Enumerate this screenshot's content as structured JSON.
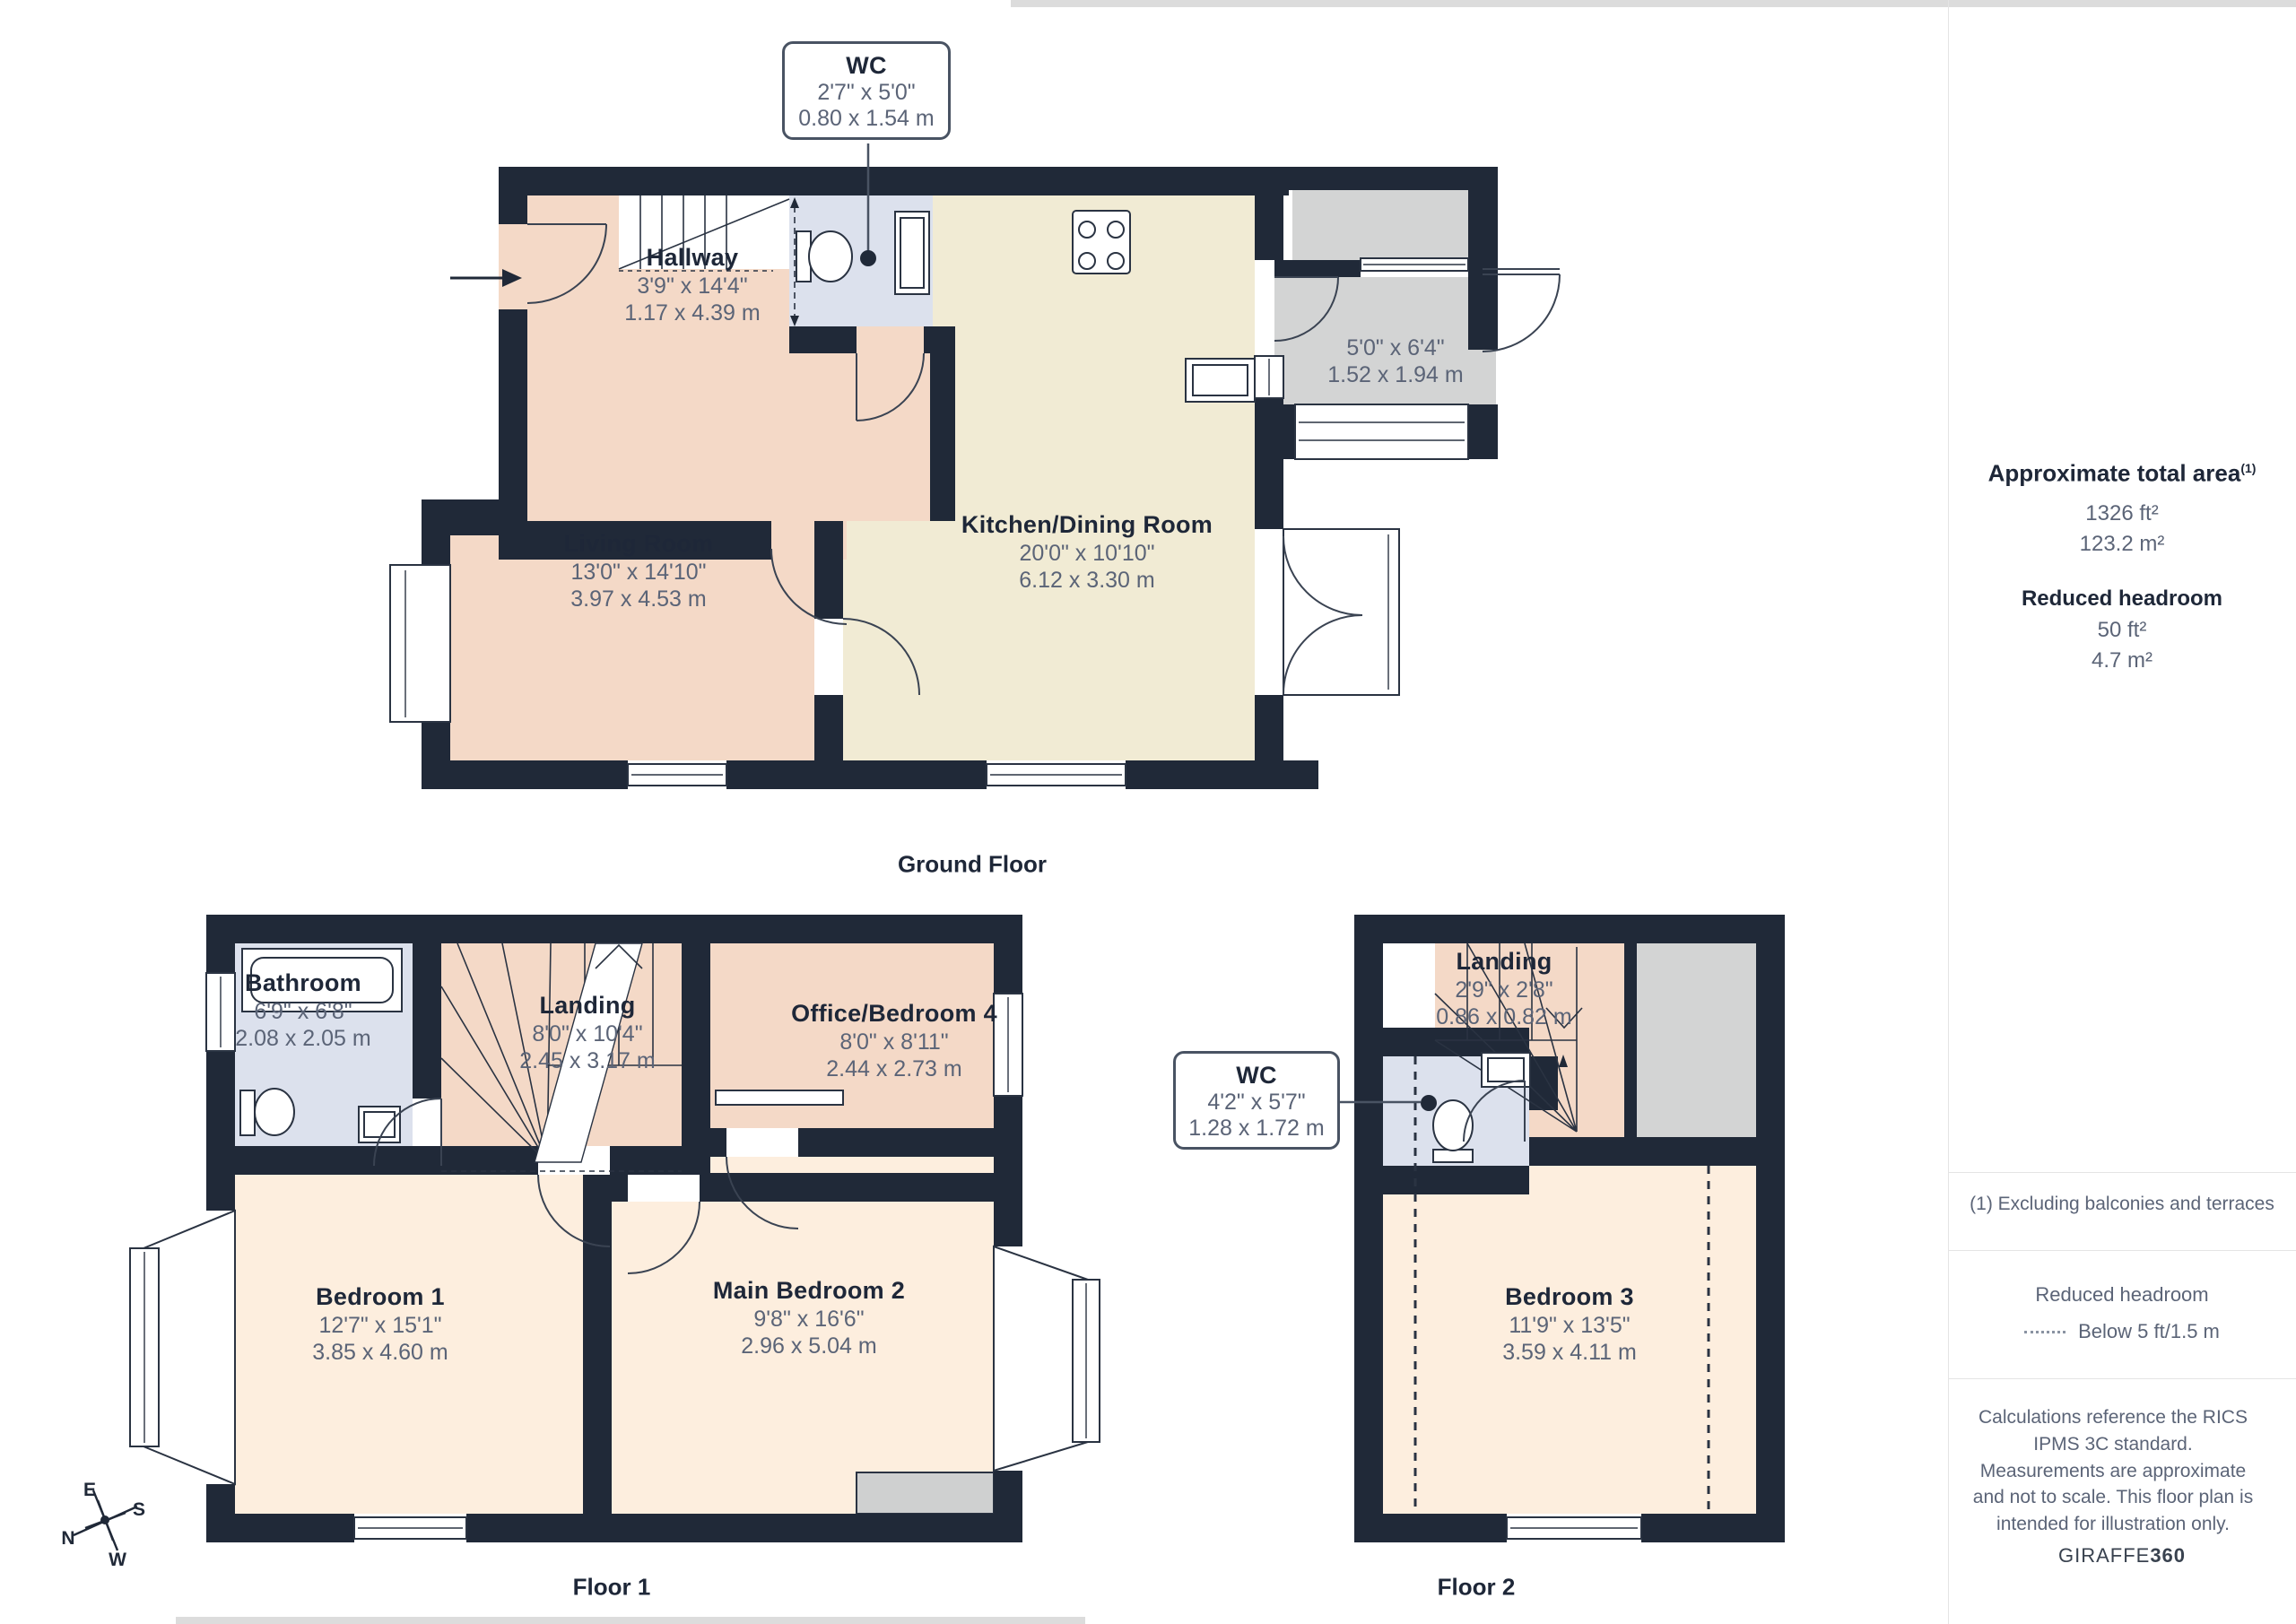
{
  "palette": {
    "wall": "#202938",
    "room_peach": "#f4d9c7",
    "room_cream": "#f1ebd4",
    "room_bedroom": "#fdeede",
    "room_wet": "#dce1ed",
    "room_gray": "#d3d4d4",
    "title_text": "#1e2738",
    "dim_text": "#5b6477"
  },
  "rooms": {
    "wc_ground": {
      "name": "WC",
      "imperial": "2'7\" x 5'0\"",
      "metric": "0.80 x 1.54 m"
    },
    "hallway": {
      "name": "Hallway",
      "imperial": "3'9\" x 14'4\"",
      "metric": "1.17 x 4.39 m"
    },
    "living": {
      "name": "Living Room",
      "imperial": "13'0\" x 14'10\"",
      "metric": "3.97 x 4.53 m"
    },
    "kitchen": {
      "name": "Kitchen/Dining Room",
      "imperial": "20'0\" x 10'10\"",
      "metric": "6.12 x 3.30 m"
    },
    "porch": {
      "imperial": "5'0\" x 6'4\"",
      "metric": "1.52 x 1.94 m"
    },
    "bathroom": {
      "name": "Bathroom",
      "imperial": "6'9\" x 6'8\"",
      "metric": "2.08 x 2.05 m"
    },
    "landing1": {
      "name": "Landing",
      "imperial": "8'0\" x 10'4\"",
      "metric": "2.45 x 3.17 m"
    },
    "office": {
      "name": "Office/Bedroom 4",
      "imperial": "8'0\" x 8'11\"",
      "metric": "2.44 x 2.73 m"
    },
    "bedroom1": {
      "name": "Bedroom 1",
      "imperial": "12'7\" x 15'1\"",
      "metric": "3.85 x 4.60 m"
    },
    "bedroom2": {
      "name": "Main Bedroom 2",
      "imperial": "9'8\" x 16'6\"",
      "metric": "2.96 x 5.04 m"
    },
    "landing2": {
      "name": "Landing",
      "imperial": "2'9\" x 2'8\"",
      "metric": "0.86 x 0.82 m"
    },
    "wc2": {
      "name": "WC",
      "imperial": "4'2\" x 5'7\"",
      "metric": "1.28 x 1.72 m"
    },
    "bedroom3": {
      "name": "Bedroom 3",
      "imperial": "11'9\" x 13'5\"",
      "metric": "3.59 x 4.11 m"
    }
  },
  "floors": {
    "ground": "Ground Floor",
    "floor1": "Floor 1",
    "floor2": "Floor 2"
  },
  "sidebar": {
    "total_area_label": "Approximate total area",
    "total_area_sup": "(1)",
    "total_area_ft": "1326 ft²",
    "total_area_m": "123.2 m²",
    "reduced_label": "Reduced headroom",
    "reduced_ft": "50 ft²",
    "reduced_m": "4.7 m²",
    "note1": "(1) Excluding balconies and terraces",
    "legend_title": "Reduced headroom",
    "legend_value": "Below 5 ft/1.5 m",
    "disclaimer": "Calculations reference the RICS IPMS 3C standard. Measurements are approximate and not to scale. This floor plan is intended for illustration only.",
    "brand_regular": "GIRAFFE",
    "brand_bold": "360"
  },
  "compass": {
    "n": "N",
    "e": "E",
    "s": "S",
    "w": "W"
  }
}
